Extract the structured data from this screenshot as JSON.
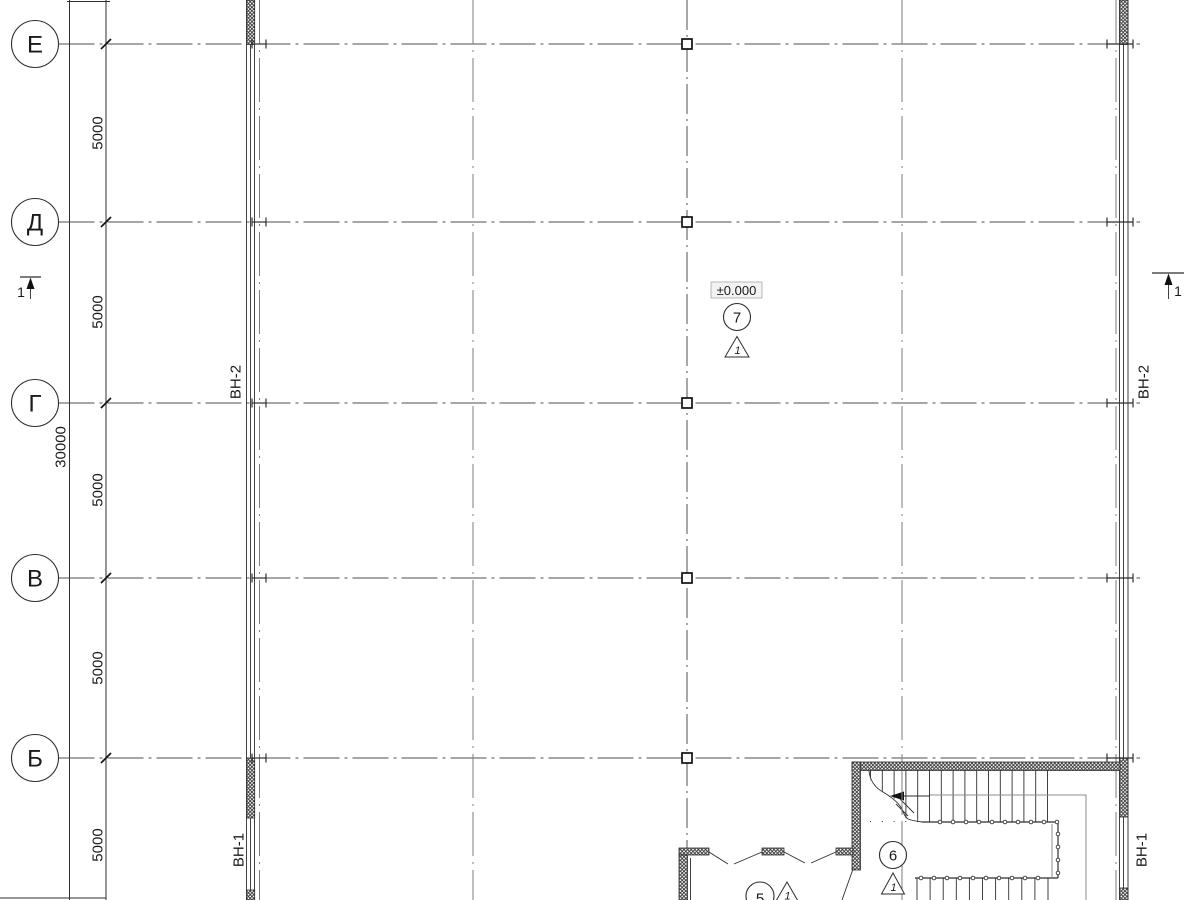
{
  "axis_bubbles": [
    "Е",
    "Д",
    "Г",
    "В",
    "Б"
  ],
  "dimension_labels": {
    "bays": [
      "5000",
      "5000",
      "5000",
      "5000",
      "5000"
    ],
    "total": "30000"
  },
  "wall_labels": {
    "vn2": "ВН-2",
    "vn1": "ВН-1"
  },
  "level_mark": {
    "value": "±0.000"
  },
  "room_markers": {
    "m7": "7",
    "m6": "6",
    "m5": "5"
  },
  "triangle_ref": "1",
  "section_mark": "1"
}
